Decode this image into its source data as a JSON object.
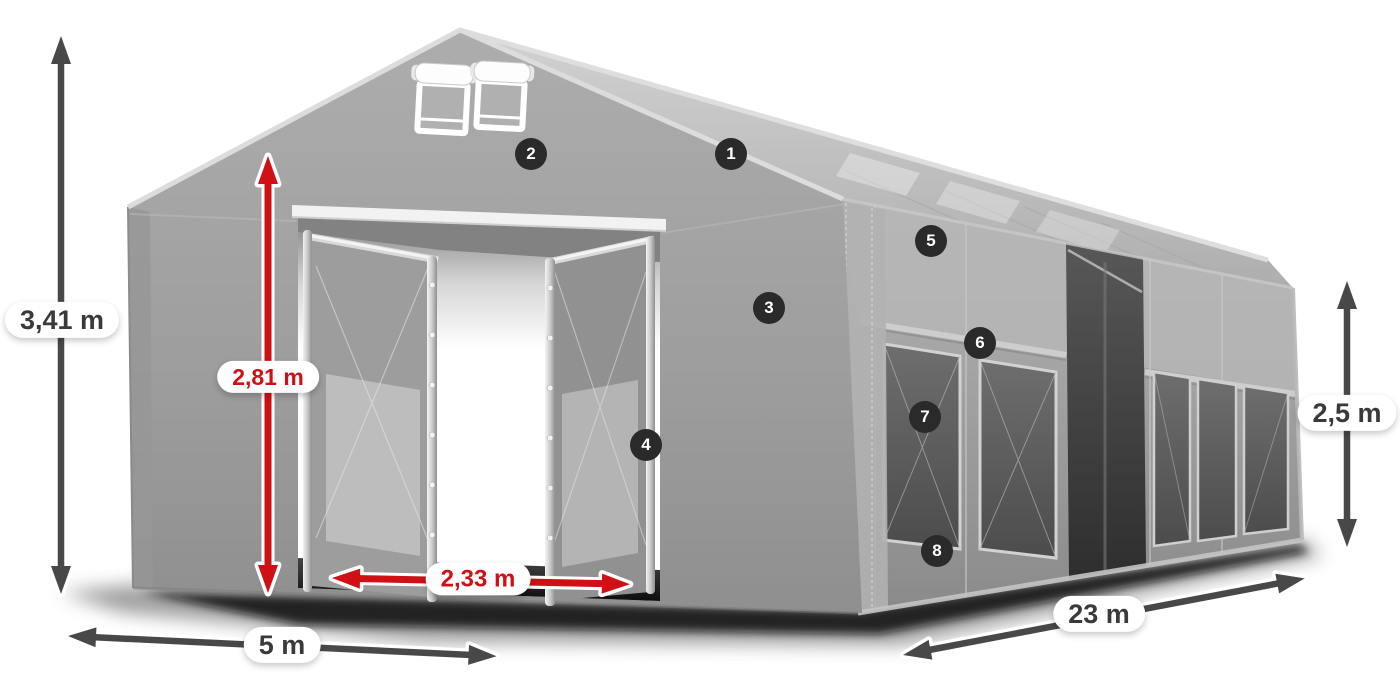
{
  "page": {
    "background": "#ffffff",
    "subject": "storage-tent-dimension-diagram"
  },
  "dimensions": {
    "total_height": {
      "value": "3,41 m",
      "style": "dark"
    },
    "entrance_height": {
      "value": "2,81 m",
      "style": "red"
    },
    "entrance_width": {
      "value": "2,33 m",
      "style": "red"
    },
    "width": {
      "value": "5 m",
      "style": "dark"
    },
    "length": {
      "value": "23 m",
      "style": "dark"
    },
    "side_height": {
      "value": "2,5 m",
      "style": "dark"
    }
  },
  "callouts": {
    "bg": "#2a2a2a",
    "text_color": "#ffffff",
    "items": [
      {
        "label": "1"
      },
      {
        "label": "2"
      },
      {
        "label": "3"
      },
      {
        "label": "4"
      },
      {
        "label": "5"
      },
      {
        "label": "6"
      },
      {
        "label": "7"
      },
      {
        "label": "8"
      }
    ]
  },
  "colors": {
    "arrow_dark": "#484848",
    "arrow_red": "#cf1015",
    "fabric": "#a3a3a3",
    "roof": "#c4c4c4"
  }
}
